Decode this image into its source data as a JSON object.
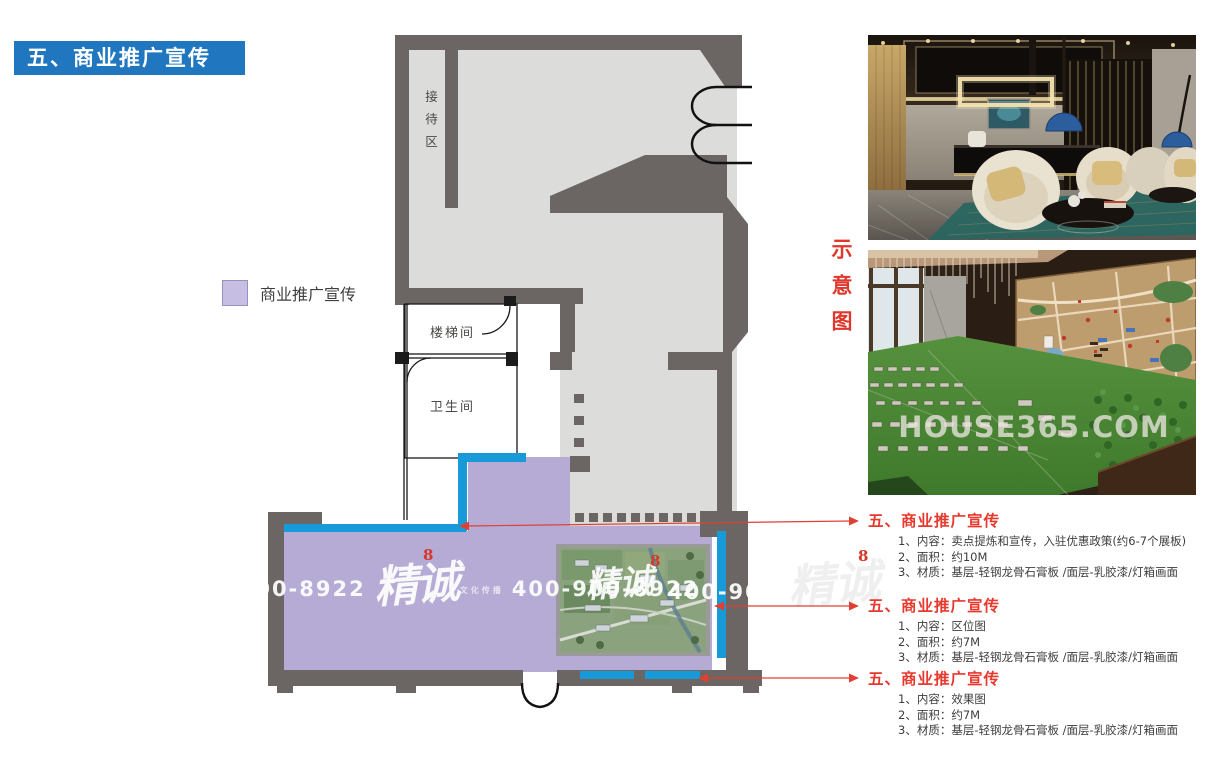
{
  "title": {
    "text": "五、商业推广宣传"
  },
  "legend": {
    "label": "商业推广宣传",
    "swatch_color": "#c7bfe3"
  },
  "floor_plan": {
    "rooms": {
      "reception": "接待区",
      "stairwell": "楼梯间",
      "bathroom": "卫生间"
    },
    "zone_color": "#b5abd5",
    "accent_blue": "#189ad8",
    "wall_color": "#6b6663",
    "floor_color": "#dcdcda"
  },
  "side_label": {
    "text": "示意图",
    "color": "#e0372c"
  },
  "watermark": {
    "phone_partial_left": "-900-8922",
    "phone": "400-900-8922",
    "phone_partial_right": "400-90",
    "brand": "精诚",
    "brand_sub": "文化传播",
    "seal": "8"
  },
  "photos": {
    "model_watermark": "HOUSE365.COM"
  },
  "annotations": [
    {
      "title": "五、商业推广宣传",
      "items": [
        "1、内容：卖点提炼和宣传，入驻优惠政策(约6-7个展板)",
        "2、面积：约10M",
        "3、材质：基层-轻钢龙骨石膏板 /面层-乳胶漆/灯箱画面"
      ]
    },
    {
      "title": "五、商业推广宣传",
      "items": [
        "1、内容：区位图",
        "2、面积：约7M",
        "3、材质：基层-轻钢龙骨石膏板 /面层-乳胶漆/灯箱画面"
      ]
    },
    {
      "title": "五、商业推广宣传",
      "items": [
        "1、内容：效果图",
        "2、面积：约7M",
        "3、材质：基层-轻钢龙骨石膏板 /面层-乳胶漆/灯箱画面"
      ]
    }
  ]
}
